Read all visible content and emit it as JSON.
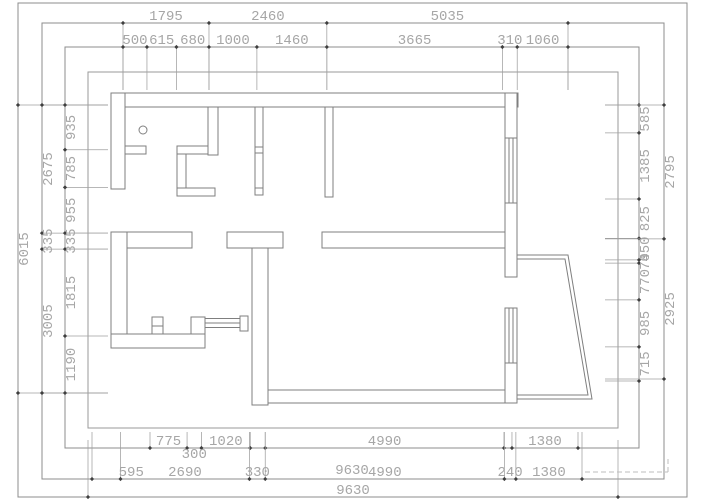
{
  "title": "Apartment floor plan CAD drawing with dimension chains (mm)",
  "colors": {
    "wall_line": "#7f7f7f",
    "frame_line": "#8c8c8c",
    "boundary_line": "#9a9a9a",
    "tick": "#3f3f3f",
    "ext_line": "#9f9f9f",
    "text": "#a6a6a6",
    "background": "#ffffff"
  },
  "dimension_rows": {
    "top_outer_row": [
      "1795",
      "2460",
      "5035"
    ],
    "top_inner_row": [
      "500",
      "615",
      "680",
      "1000",
      "1460",
      "3665",
      "310",
      "1060"
    ],
    "left_outer_col": [
      "6015"
    ],
    "left_middle_col": [
      "2675",
      "335",
      "3005"
    ],
    "left_inner_col": [
      "935",
      "785",
      "955",
      "335",
      "1815",
      "1190"
    ],
    "right_inner_col": [
      "585",
      "1385",
      "825",
      "450",
      "70",
      "770",
      "985",
      "715"
    ],
    "right_outer_col": [
      "2795",
      "2925"
    ],
    "bottom_inner_row": [
      "775",
      "300",
      "1020",
      "4990",
      "1380"
    ],
    "bottom_middle_row": [
      "595",
      "2690",
      "330",
      "4990",
      "240",
      "1380"
    ],
    "bottom_middle_overlap": "9630",
    "bottom_outer_row": [
      "9630"
    ]
  },
  "plan_features": [
    "exterior-boundary",
    "top-wall",
    "left-wall",
    "closet-walls",
    "bathroom",
    "sliding-door",
    "interior-partitions",
    "right-wall-windows",
    "angled-bay-window",
    "column-symbol"
  ]
}
